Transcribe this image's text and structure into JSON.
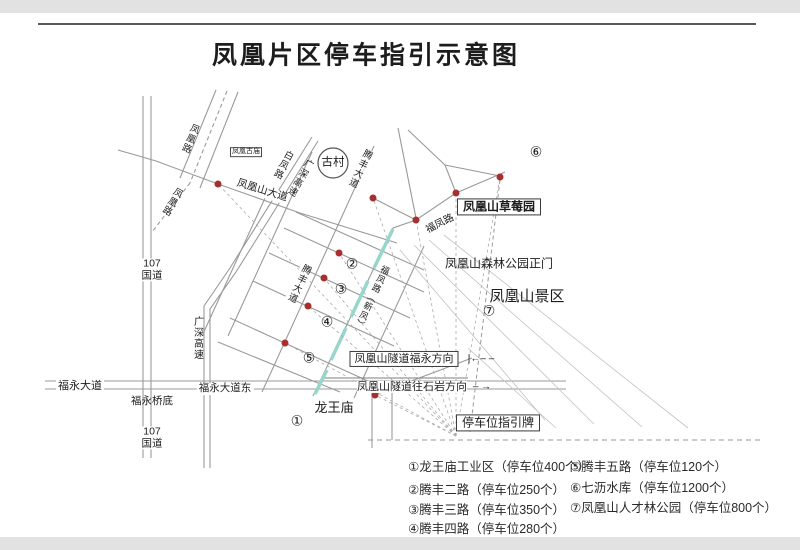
{
  "title": "凤凰片区停车指引示意图",
  "map": {
    "roads": {
      "g107_top": "107国道",
      "g107_bottom": "107国道",
      "guangshen_vertical": "广深高速",
      "guangshen_diagonal": "广深高速",
      "fuyong_dadao": "福永大道",
      "fuyong_dadao_east": "福永大道东",
      "fuyong_qiaodi": "福永桥底",
      "fenghuangshan_dadao": "凤凰山大道",
      "fenghuang_lu_1": "凤凰路",
      "fenghuang_lu_2": "凤凰路",
      "baifeng_lu": "白凤路",
      "tengfeng_dadao_top": "腾丰大道",
      "tengfeng_dadao_mid": "腾丰大道",
      "fufeng_lu": "福凤路",
      "fufeng_lu_highlight": "福凤路（新凤）"
    },
    "places": {
      "gucun": "古村",
      "gumiao": "凤凰古庙",
      "strawberry": "凤凰山草莓园",
      "forest_gate": "凤凰山森林公园正门",
      "scenic": "凤凰山景区",
      "longwangmiao": "龙王庙",
      "parking_sign": "停车位指引牌"
    },
    "tunnel": {
      "to_fuyong": "凤凰山隧道福永方向",
      "to_fuyong_arrow": "|←– –",
      "to_shiyan": "凤凰山隧道往石岩方向",
      "to_shiyan_arrow": "– →"
    },
    "markers": {
      "m1": "①",
      "m2": "②",
      "m3": "③",
      "m4": "④",
      "m5": "⑤",
      "m6": "⑥",
      "m7": "⑦"
    }
  },
  "legend": {
    "items": [
      "①龙王庙工业区（停车位400个）",
      "②腾丰二路（停车位250个）",
      "③腾丰三路（停车位350个）",
      "④腾丰四路（停车位280个）",
      "⑤腾丰五路（停车位120个）",
      "⑥七沥水库（停车位1200个）",
      "⑦凤凰山人才林公园（停车位800个）"
    ]
  },
  "colors": {
    "marker_red": "#a53030",
    "road_highlight": "#97d6ca",
    "road_gray": "#9a9a9a",
    "text": "#1d1d1d"
  }
}
